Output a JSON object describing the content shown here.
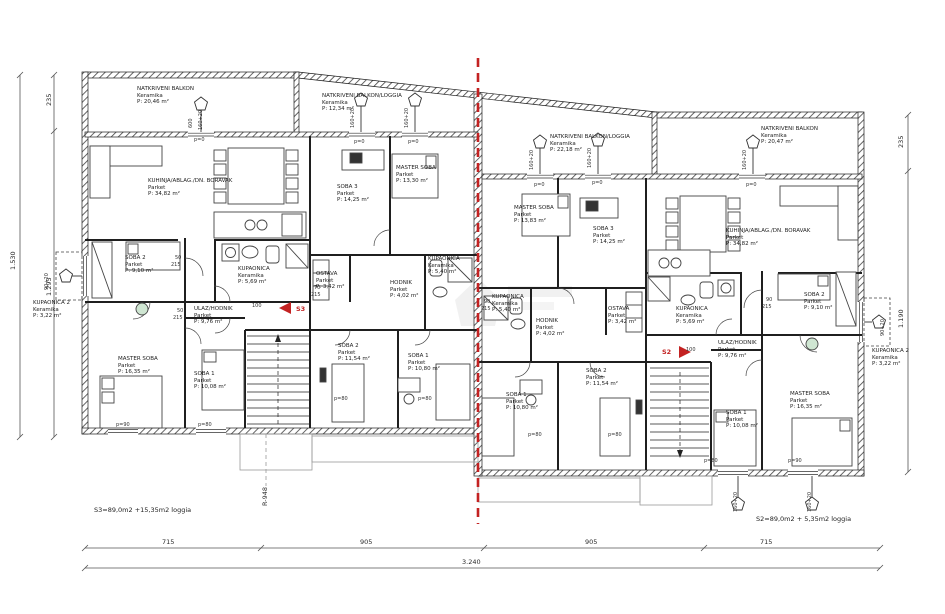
{
  "page": {
    "type": "architectural floor plan — two mirrored apartment units",
    "background": "#ffffff"
  },
  "colors": {
    "wall": "#1f1f1f",
    "linework": "#444444",
    "dimension": "#555555",
    "symmetry_red": "#c32222",
    "fixture_green": "#cfe6d2",
    "watermark": "#bdbdbd"
  },
  "rooms": [
    {
      "unit": "left",
      "name": "NATKRIVENI BALKON",
      "floor": "Keramika",
      "area": "P: 20,46 m²",
      "x": 137,
      "y": 86
    },
    {
      "unit": "left",
      "name": "NATKRIVENI BALKON/LOGGIA",
      "floor": "Keramika",
      "area": "P: 12,34 m²",
      "x": 322,
      "y": 93
    },
    {
      "unit": "left",
      "name": "KUHINJA/ABLAG./DN. BORAVAK",
      "floor": "Parket",
      "area": "P: 34,82 m²",
      "x": 148,
      "y": 178
    },
    {
      "unit": "left",
      "name": "SOBA 3",
      "floor": "Parket",
      "area": "P: 14,25 m²",
      "x": 337,
      "y": 184
    },
    {
      "unit": "left",
      "name": "MASTER SOBA",
      "floor": "Parket",
      "area": "P: 13,30 m²",
      "x": 396,
      "y": 165
    },
    {
      "unit": "left",
      "name": "SOBA 2",
      "floor": "Parket",
      "area": "P: 9,10 m²",
      "x": 125,
      "y": 255
    },
    {
      "unit": "left",
      "name": "KUPAONICA 2",
      "floor": "Keramika",
      "area": "P: 3,22 m²",
      "x": 33,
      "y": 300
    },
    {
      "unit": "left",
      "name": "KUPAONICA",
      "floor": "Keramika",
      "area": "P: 5,69 m²",
      "x": 238,
      "y": 266
    },
    {
      "unit": "left",
      "name": "ULAZ/HODNIK",
      "floor": "Parket",
      "area": "P: 9,76 m²",
      "x": 194,
      "y": 306
    },
    {
      "unit": "left",
      "name": "MASTER SOBA",
      "floor": "Parket",
      "area": "P: 16,35 m²",
      "x": 118,
      "y": 356
    },
    {
      "unit": "left",
      "name": "SOBA 1",
      "floor": "Parket",
      "area": "P: 10,08 m²",
      "x": 194,
      "y": 371
    },
    {
      "unit": "left",
      "name": "OSTAVA",
      "floor": "Parket",
      "area": "P: 3,42 m²",
      "x": 316,
      "y": 271
    },
    {
      "unit": "left",
      "name": "HODNIK",
      "floor": "Parket",
      "area": "P: 4,02 m²",
      "x": 390,
      "y": 280
    },
    {
      "unit": "left",
      "name": "KUPAONICA",
      "floor": "Keramika",
      "area": "P: 5,40 m²",
      "x": 428,
      "y": 256
    },
    {
      "unit": "left",
      "name": "SOBA 2",
      "floor": "Parket",
      "area": "P: 11,54 m²",
      "x": 338,
      "y": 343
    },
    {
      "unit": "left",
      "name": "SOBA 1",
      "floor": "Parket",
      "area": "P: 10,80 m²",
      "x": 408,
      "y": 353
    },
    {
      "unit": "right",
      "name": "NATKRIVENI BALKON/LOGGIA",
      "floor": "Keramika",
      "area": "P: 22,18 m²",
      "x": 550,
      "y": 134
    },
    {
      "unit": "right",
      "name": "NATKRIVENI BALKON",
      "floor": "Keramika",
      "area": "P: 20,47 m²",
      "x": 761,
      "y": 126
    },
    {
      "unit": "right",
      "name": "MASTER SOBA",
      "floor": "Parket",
      "area": "P: 13,83 m²",
      "x": 514,
      "y": 205
    },
    {
      "unit": "right",
      "name": "SOBA 3",
      "floor": "Parket",
      "area": "P: 14,25 m²",
      "x": 593,
      "y": 226
    },
    {
      "unit": "right",
      "name": "KUHINJA/ABLAG./DN. BORAVAK",
      "floor": "Parket",
      "area": "P: 34,82 m²",
      "x": 726,
      "y": 228
    },
    {
      "unit": "right",
      "name": "KUPAONICA",
      "floor": "Keramika",
      "area": "P: 5,40 m²",
      "x": 492,
      "y": 294
    },
    {
      "unit": "right",
      "name": "HODNIK",
      "floor": "Parket",
      "area": "P: 4,02 m²",
      "x": 536,
      "y": 318
    },
    {
      "unit": "right",
      "name": "OSTAVA",
      "floor": "Parket",
      "area": "P: 3,42 m²",
      "x": 608,
      "y": 306
    },
    {
      "unit": "right",
      "name": "SOBA 2",
      "floor": "Parket",
      "area": "P: 11,54 m²",
      "x": 586,
      "y": 368
    },
    {
      "unit": "right",
      "name": "SOBA 1",
      "floor": "Parket",
      "area": "P: 10,80 m²",
      "x": 506,
      "y": 392
    },
    {
      "unit": "right",
      "name": "KUPAONICA",
      "floor": "Keramika",
      "area": "P: 5,69 m²",
      "x": 676,
      "y": 306
    },
    {
      "unit": "right",
      "name": "ULAZ/HODNIK",
      "floor": "Parket",
      "area": "P: 9,76 m²",
      "x": 718,
      "y": 340
    },
    {
      "unit": "right",
      "name": "SOBA 2",
      "floor": "Parket",
      "area": "P: 9,10 m²",
      "x": 804,
      "y": 292
    },
    {
      "unit": "right",
      "name": "MASTER SOBA",
      "floor": "Parket",
      "area": "P: 16,35 m²",
      "x": 790,
      "y": 391
    },
    {
      "unit": "right",
      "name": "SOBA 1",
      "floor": "Parket",
      "area": "P: 10,08 m²",
      "x": 726,
      "y": 410
    },
    {
      "unit": "right",
      "name": "KUPAONICA 2",
      "floor": "Keramika",
      "area": "P: 3,22 m²",
      "x": 872,
      "y": 348
    }
  ],
  "stairs": {
    "left": {
      "label": "S3",
      "x": 296,
      "y": 306
    },
    "right": {
      "label": "S2",
      "x": 662,
      "y": 349
    }
  },
  "summaries": {
    "left": {
      "text": "S3=89,0m2 +15,35m2 loggia",
      "x": 94,
      "y": 507
    },
    "right": {
      "text": "S2=89,0m2 + 5,35m2 loggia",
      "x": 756,
      "y": 516
    }
  },
  "dimensions": {
    "bottom_segments": [
      "715",
      "905",
      "905",
      "715"
    ],
    "bottom_total": "3.240",
    "left_outer": "1.530",
    "left_segments": [
      "235",
      "1.295"
    ],
    "right_segments": [
      "235",
      "1.190"
    ],
    "section_mark": "R-948"
  },
  "annotations": [
    {
      "text": "715",
      "x": 162,
      "y": 539,
      "big": true
    },
    {
      "text": "905",
      "x": 360,
      "y": 539,
      "big": true
    },
    {
      "text": "905",
      "x": 585,
      "y": 539,
      "big": true
    },
    {
      "text": "715",
      "x": 760,
      "y": 539,
      "big": true
    },
    {
      "text": "3.240",
      "x": 462,
      "y": 559,
      "big": true
    },
    {
      "text": "1.530",
      "x": 10,
      "y": 270,
      "rot": true,
      "big": true
    },
    {
      "text": "235",
      "x": 46,
      "y": 106,
      "rot": true,
      "big": true
    },
    {
      "text": "1.295",
      "x": 46,
      "y": 296,
      "rot": true,
      "big": true
    },
    {
      "text": "235",
      "x": 898,
      "y": 148,
      "rot": true,
      "big": true
    },
    {
      "text": "1.190",
      "x": 898,
      "y": 328,
      "rot": true,
      "big": true
    },
    {
      "text": "R-948",
      "x": 262,
      "y": 506,
      "rot": true,
      "big": true
    },
    {
      "text": "600",
      "x": 188,
      "y": 128,
      "rot": true
    },
    {
      "text": "160+20",
      "x": 198,
      "y": 130,
      "rot": true
    },
    {
      "text": "160+20",
      "x": 350,
      "y": 128,
      "rot": true
    },
    {
      "text": "160+20",
      "x": 404,
      "y": 128,
      "rot": true
    },
    {
      "text": "160+20",
      "x": 529,
      "y": 170,
      "rot": true
    },
    {
      "text": "160+20",
      "x": 587,
      "y": 168,
      "rot": true
    },
    {
      "text": "160+20",
      "x": 742,
      "y": 170,
      "rot": true
    },
    {
      "text": "160+20",
      "x": 733,
      "y": 512,
      "rot": true
    },
    {
      "text": "160+20",
      "x": 807,
      "y": 512,
      "rot": true
    },
    {
      "text": "90+20",
      "x": 44,
      "y": 290,
      "rot": true
    },
    {
      "text": "90+20",
      "x": 880,
      "y": 336,
      "rot": true
    },
    {
      "text": "p=0",
      "x": 194,
      "y": 137
    },
    {
      "text": "p=0",
      "x": 354,
      "y": 139
    },
    {
      "text": "p=0",
      "x": 408,
      "y": 139
    },
    {
      "text": "p=0",
      "x": 534,
      "y": 182
    },
    {
      "text": "p=0",
      "x": 592,
      "y": 180
    },
    {
      "text": "p=0",
      "x": 746,
      "y": 182
    },
    {
      "text": "50",
      "x": 175,
      "y": 255
    },
    {
      "text": "215",
      "x": 171,
      "y": 262
    },
    {
      "text": "50",
      "x": 177,
      "y": 308
    },
    {
      "text": "215",
      "x": 173,
      "y": 315
    },
    {
      "text": "70",
      "x": 314,
      "y": 285
    },
    {
      "text": "215",
      "x": 311,
      "y": 292
    },
    {
      "text": "100",
      "x": 252,
      "y": 303
    },
    {
      "text": "100",
      "x": 686,
      "y": 347
    },
    {
      "text": "90",
      "x": 766,
      "y": 297
    },
    {
      "text": "215",
      "x": 762,
      "y": 304
    },
    {
      "text": "90",
      "x": 484,
      "y": 299
    },
    {
      "text": "215",
      "x": 481,
      "y": 306
    },
    {
      "text": "p=90",
      "x": 116,
      "y": 422
    },
    {
      "text": "p=80",
      "x": 198,
      "y": 422
    },
    {
      "text": "p=80",
      "x": 334,
      "y": 396
    },
    {
      "text": "p=80",
      "x": 418,
      "y": 396
    },
    {
      "text": "p=80",
      "x": 528,
      "y": 432
    },
    {
      "text": "p=80",
      "x": 608,
      "y": 432
    },
    {
      "text": "p=80",
      "x": 704,
      "y": 458
    },
    {
      "text": "p=90",
      "x": 788,
      "y": 458
    }
  ]
}
